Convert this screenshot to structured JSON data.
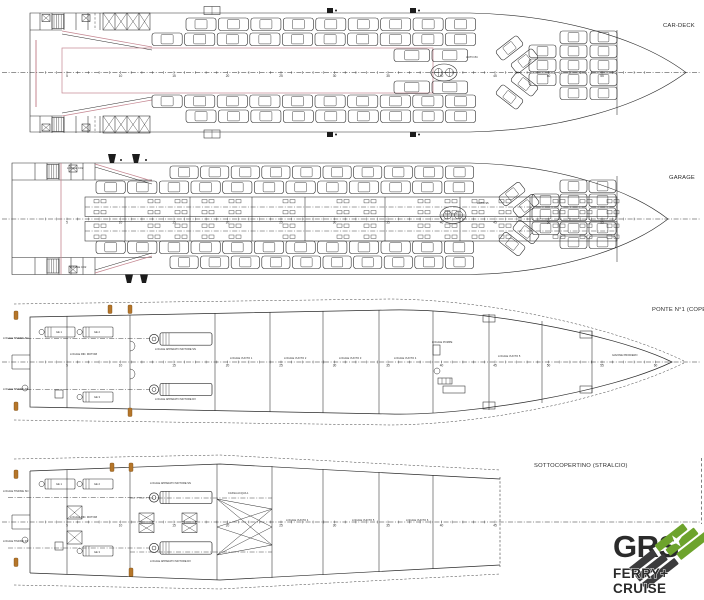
{
  "drawing": {
    "colors": {
      "ink": "#2b2b2b",
      "pink": "#c4848f",
      "amber": "#b5762a"
    },
    "decks": [
      {
        "id": "car-deck",
        "label": "CAR-DECK",
        "auto_note": "AUTO 84",
        "frame_numbers": {
          "first": 5,
          "last": 55,
          "step": 5
        },
        "car_rows": [
          {
            "y": 18,
            "x0": 186,
            "x1": 478,
            "n": 9
          },
          {
            "y": 33,
            "x0": 152,
            "x1": 478,
            "n": 10
          },
          {
            "y": 95,
            "x0": 152,
            "x1": 478,
            "n": 10
          },
          {
            "y": 110,
            "x0": 186,
            "x1": 478,
            "n": 9
          },
          {
            "y": 49,
            "x0": 394,
            "x1": 470,
            "n": 2
          },
          {
            "y": 81,
            "x0": 394,
            "x1": 470,
            "n": 2
          }
        ],
        "bow_row_y": [
          31,
          45,
          59,
          73,
          87
        ],
        "bow_cols": [
          {
            "x": 529,
            "rows": [
              1,
              2,
              3
            ]
          },
          {
            "x": 560,
            "rows": [
              0,
              1,
              2,
              3,
              4
            ]
          },
          {
            "x": 590,
            "rows": [
              0,
              1,
              2,
              3,
              4
            ]
          }
        ],
        "labels": []
      },
      {
        "id": "garage",
        "label": "GARAGE",
        "auto_note": "AUTO 95",
        "frame_numbers": {
          "first": 5,
          "last": 55,
          "step": 5
        },
        "car_rows": [
          {
            "y": 166,
            "x0": 170,
            "x1": 476,
            "n": 10
          },
          {
            "y": 181,
            "x0": 96,
            "x1": 476,
            "n": 12
          },
          {
            "y": 241,
            "x0": 96,
            "x1": 476,
            "n": 12
          },
          {
            "y": 256,
            "x0": 170,
            "x1": 476,
            "n": 10
          }
        ],
        "bow_row_y": [
          180,
          194,
          208,
          222,
          236
        ],
        "bow_cols": [
          {
            "x": 532,
            "rows": [
              1,
              2,
              3
            ]
          },
          {
            "x": 560,
            "rows": [
              0,
              1,
              2,
              3,
              4
            ]
          },
          {
            "x": 589,
            "rows": [
              0,
              1,
              2,
              3,
              4
            ]
          }
        ],
        "labels": [
          {
            "text": "LOCALE CO2",
            "x": 67,
            "y": 169
          },
          {
            "text": "LOCALE CO2",
            "x": 70,
            "y": 268
          }
        ]
      },
      {
        "id": "ponte-n1",
        "label": "PONTE N°1 (COPE",
        "auto_note": "",
        "frame_numbers": {
          "first": 5,
          "last": 60,
          "step": 5
        },
        "car_rows": [],
        "labels": [
          {
            "text": "LOCALE TIMONE SN",
            "x": 3,
            "y": 339
          },
          {
            "text": "LOCALE TIMONE DX",
            "x": 3,
            "y": 390
          },
          {
            "text": "GE 1",
            "x": 56,
            "y": 333
          },
          {
            "text": "GE 2",
            "x": 94,
            "y": 333
          },
          {
            "text": "GE 3",
            "x": 94,
            "y": 398
          },
          {
            "text": "LOCALE RID. MOTORI",
            "x": 70,
            "y": 355
          },
          {
            "text": "LOCALE APPARATO MOTORE SN",
            "x": 155,
            "y": 350
          },
          {
            "text": "LOCALE APPARATO MOTORE DX",
            "x": 155,
            "y": 400
          },
          {
            "text": "LOCALE VUOTO 1",
            "x": 230,
            "y": 359
          },
          {
            "text": "LOCALE VUOTO 2",
            "x": 284,
            "y": 359
          },
          {
            "text": "LOCALE VUOTO 3",
            "x": 339,
            "y": 359
          },
          {
            "text": "LOCALE VUOTO 4",
            "x": 394,
            "y": 359
          },
          {
            "text": "LOCALE POMPE",
            "x": 432,
            "y": 343
          },
          {
            "text": "LOCALE VUOTO 5",
            "x": 498,
            "y": 357
          },
          {
            "text": "GAVONE PRODIERO",
            "x": 612,
            "y": 356
          }
        ]
      },
      {
        "id": "sottocopertino",
        "label": "SOTTOCOPERTINO (STRALCIO)",
        "auto_note": "",
        "frame_numbers": {
          "first": 5,
          "last": 45,
          "step": 5
        },
        "car_rows": [],
        "labels": [
          {
            "text": "LOCALE TIMONE SN",
            "x": 3,
            "y": 492
          },
          {
            "text": "LOCALE TIMONE DX",
            "x": 3,
            "y": 542
          },
          {
            "text": "GE 1",
            "x": 56,
            "y": 485
          },
          {
            "text": "GE 2",
            "x": 94,
            "y": 485
          },
          {
            "text": "GE 3",
            "x": 94,
            "y": 553
          },
          {
            "text": "LOCALE RID. MOTORI",
            "x": 70,
            "y": 518
          },
          {
            "text": "LOCALE APPARATO MOTORE SN",
            "x": 150,
            "y": 484
          },
          {
            "text": "LOCALE APPARATO MOTORE DX",
            "x": 150,
            "y": 562
          },
          {
            "text": "CASSA ACQUA 1",
            "x": 228,
            "y": 494
          },
          {
            "text": "LOCALE VUOTO 4",
            "x": 286,
            "y": 521
          },
          {
            "text": "LOCALE VUOTO 5",
            "x": 352,
            "y": 521
          },
          {
            "text": "LOCALE VUOTO 6",
            "x": 406,
            "y": 521
          }
        ]
      }
    ],
    "logo": {
      "brand": "GRS",
      "line1": "FERRY+",
      "line2": "CRUISE",
      "green": "#6da32c",
      "dark": "#3b3b3c"
    }
  }
}
